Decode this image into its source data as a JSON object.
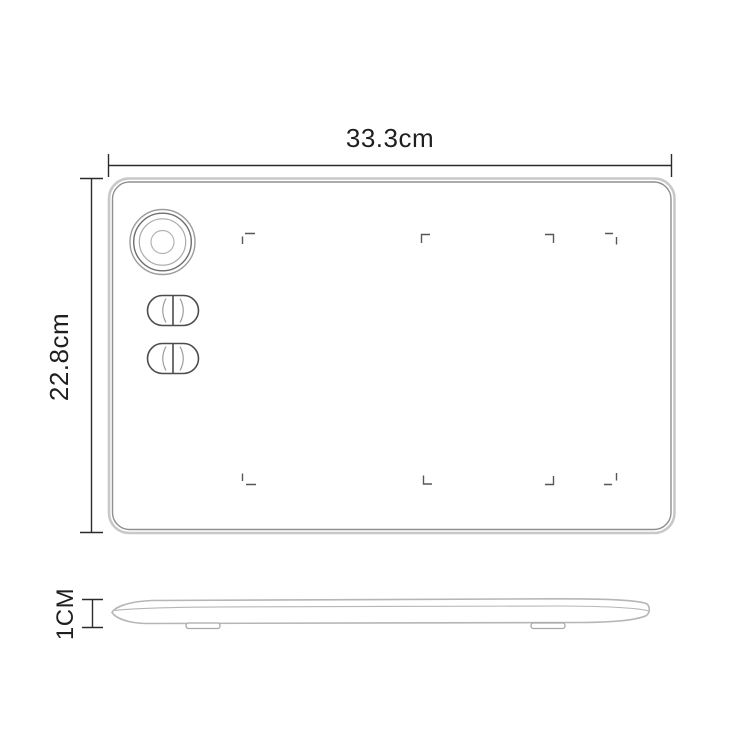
{
  "page": {
    "background": "#ffffff",
    "description": "Product dimension diagram of a graphics drawing tablet: top view with rotary dial, two dual-button groups and active-area corner marks, plus a thin side profile view with rubber feet"
  },
  "dimensions": {
    "width": {
      "label": "33.3cm"
    },
    "height": {
      "label": "22.8cm"
    },
    "thickness": {
      "label": "1CM"
    }
  },
  "components": {
    "dial": "rotary-dial",
    "button_groups": 2,
    "buttons_per_group": 2,
    "active_area_marks": 8,
    "feet": 2
  },
  "colors": {
    "dimension_line": "#2b2b2b",
    "label_text": "#1f1f1f",
    "outline_light": "#c8c8c8",
    "outline_mid": "#b6b6b6",
    "outline_dark": "#8f8f8f",
    "dial_dark": "#6f6f6f",
    "dial_light": "#ababab",
    "control_dark": "#4c4c4c",
    "control_light": "#9d9d9d",
    "mark": "#575757",
    "foot": "#a9a9a9"
  }
}
